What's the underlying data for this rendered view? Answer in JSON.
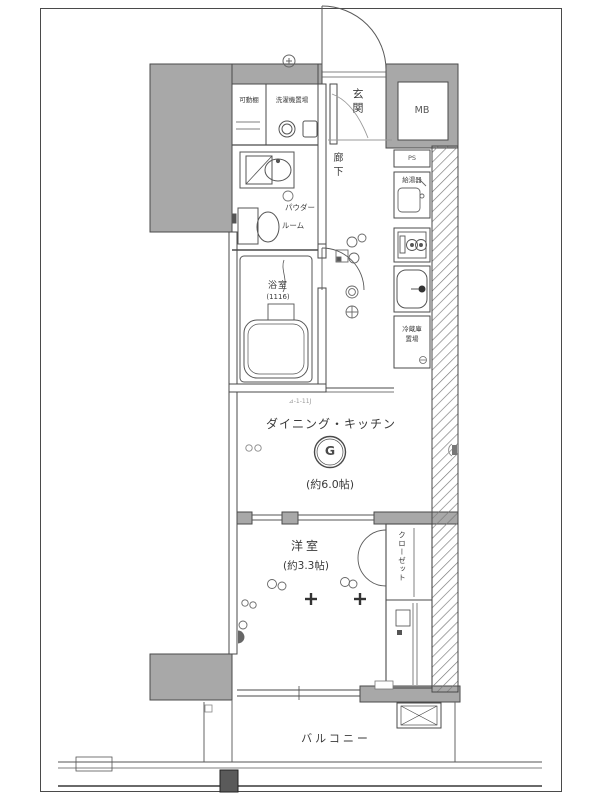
{
  "colors": {
    "wall": "#a8a8a8",
    "line": "#4a4a4a",
    "text": "#3a3a3a"
  },
  "rooms": {
    "entrance": {
      "label": "玄関"
    },
    "meter_box": {
      "label": "MB"
    },
    "pipe_space": {
      "label": "PS"
    },
    "movable_shelf": {
      "label": "可動棚"
    },
    "laundry": {
      "label": "洗濯機置場"
    },
    "powder_room": {
      "label_line1": "パウダー",
      "label_line2": "ルーム"
    },
    "hallway": {
      "label": "廊下"
    },
    "bathroom": {
      "label": "浴室",
      "size": "(1116)"
    },
    "water_heater": {
      "label": "給湯器"
    },
    "refrigerator_space": {
      "label_line1": "冷蔵庫",
      "label_line2": "置場"
    },
    "dining_kitchen": {
      "label": "ダイニング・キッチン",
      "size": "(約6.0帖)",
      "gas_symbol": "G",
      "note": "⊿-1-11J"
    },
    "western_room": {
      "label": "洋室",
      "size": "(約3.3帖)"
    },
    "closet": {
      "label": "クローゼット"
    },
    "balcony": {
      "label": "バルコニー"
    }
  }
}
